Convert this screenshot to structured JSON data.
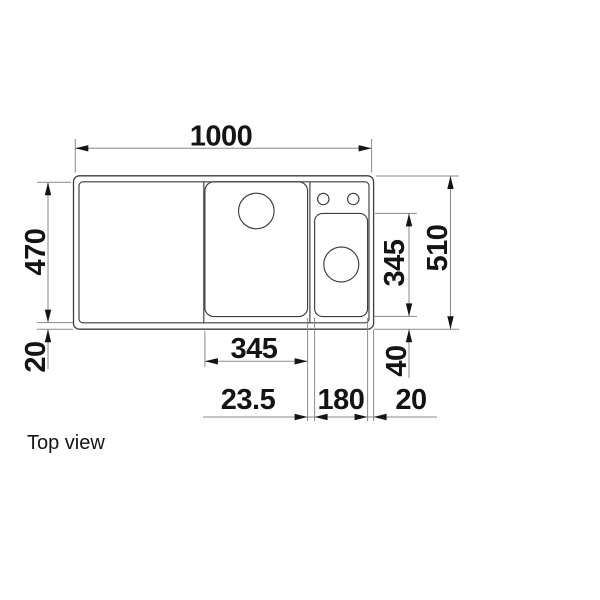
{
  "drawing": {
    "caption": "Top view",
    "dims": {
      "width_overall": "1000",
      "depth_inner": "470",
      "rim_bottom": "20",
      "bowl_width": "345",
      "half_bowl_depth": "345",
      "depth_overall": "510",
      "half_bowl_bottom_offset": "40",
      "bowl_gap": "23.5",
      "half_bowl_width": "180",
      "rim_right": "20"
    },
    "colors": {
      "background": "#ffffff",
      "outline": "#3d3d3d",
      "dim_line": "#8a8a8a",
      "text": "#141414"
    }
  }
}
